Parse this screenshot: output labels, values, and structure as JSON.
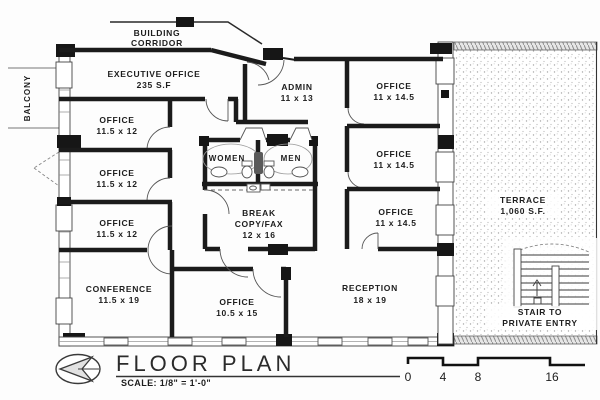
{
  "plan": {
    "balcony": "BALCONY",
    "corridor": {
      "line1": "BUILDING",
      "line2": "CORRIDOR"
    },
    "rooms": {
      "executive": {
        "name": "EXECUTIVE OFFICE",
        "dims": "235 S.F"
      },
      "admin": {
        "name": "ADMIN",
        "dims": "11 x 13"
      },
      "office_r1": {
        "name": "OFFICE",
        "dims": "11 x 14.5"
      },
      "office_r2": {
        "name": "OFFICE",
        "dims": "11 x 14.5"
      },
      "office_r3": {
        "name": "OFFICE",
        "dims": "11 x 14.5"
      },
      "office_l1": {
        "name": "OFFICE",
        "dims": "11.5 x 12"
      },
      "office_l2": {
        "name": "OFFICE",
        "dims": "11.5 x 12"
      },
      "office_l3": {
        "name": "OFFICE",
        "dims": "11.5 x 12"
      },
      "conference": {
        "name": "CONFERENCE",
        "dims": "11.5 x 19"
      },
      "office_c": {
        "name": "OFFICE",
        "dims": "10.5 x 15"
      },
      "reception": {
        "name": "RECEPTION",
        "dims": "18 x 19"
      },
      "break_room": {
        "name": "BREAK",
        "name2": "COPY/FAX",
        "dims": "12 x 16"
      },
      "women": "WOMEN",
      "men": "MEN",
      "terrace": {
        "name": "TERRACE",
        "dims": "1,060 S.F."
      },
      "stair": {
        "line1": "STAIR TO",
        "line2": "PRIVATE ENTRY"
      }
    },
    "title": {
      "text": "FLOOR PLAN",
      "scale": "SCALE: 1/8\" = 1'-0\""
    },
    "scale_bar": {
      "t0": "0",
      "t4": "4",
      "t8": "8",
      "t16": "16"
    },
    "colors": {
      "ink": "#1b1b1b",
      "paper": "#fdfdfd"
    }
  }
}
